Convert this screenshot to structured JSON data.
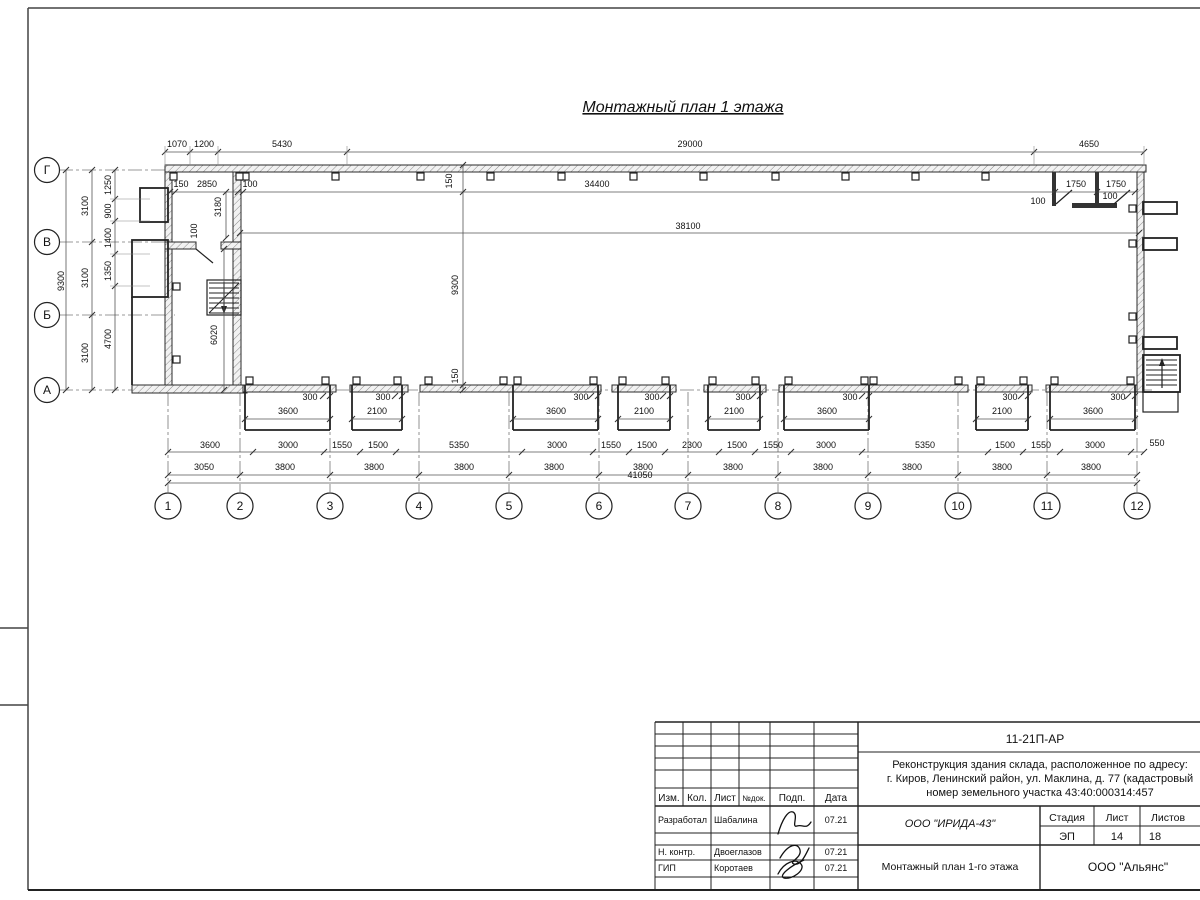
{
  "title": "Монтажный план 1 этажа",
  "plan": {
    "dims": [
      {
        "t": "1070",
        "x": 177,
        "y": 147
      },
      {
        "t": "1200",
        "x": 204,
        "y": 147
      },
      {
        "t": "5430",
        "x": 282,
        "y": 147
      },
      {
        "t": "29000",
        "x": 690,
        "y": 147
      },
      {
        "t": "4650",
        "x": 1089,
        "y": 147
      },
      {
        "t": "150",
        "x": 181,
        "y": 187
      },
      {
        "t": "2850",
        "x": 207,
        "y": 187
      },
      {
        "t": "100",
        "x": 250,
        "y": 187
      },
      {
        "t": "34400",
        "x": 597,
        "y": 187
      },
      {
        "t": "1750",
        "x": 1076,
        "y": 187
      },
      {
        "t": "1750",
        "x": 1116,
        "y": 187
      },
      {
        "t": "100",
        "x": 1038,
        "y": 204
      },
      {
        "t": "100",
        "x": 1110,
        "y": 199
      },
      {
        "t": "38100",
        "x": 688,
        "y": 229
      },
      {
        "t": "150",
        "x": 452,
        "y": 181,
        "r": -90
      },
      {
        "t": "9300",
        "x": 458,
        "y": 285,
        "r": -90
      },
      {
        "t": "150",
        "x": 458,
        "y": 376,
        "r": -90
      },
      {
        "t": "3180",
        "x": 221,
        "y": 207,
        "r": -90
      },
      {
        "t": "100",
        "x": 197,
        "y": 231,
        "r": -90
      },
      {
        "t": "6020",
        "x": 217,
        "y": 335,
        "r": -90
      },
      {
        "t": "1250",
        "x": 111,
        "y": 185,
        "r": -90
      },
      {
        "t": "900",
        "x": 111,
        "y": 211,
        "r": -90
      },
      {
        "t": "1400",
        "x": 111,
        "y": 238,
        "r": -90
      },
      {
        "t": "1350",
        "x": 111,
        "y": 271,
        "r": -90
      },
      {
        "t": "4700",
        "x": 111,
        "y": 339,
        "r": -90
      },
      {
        "t": "3100",
        "x": 88,
        "y": 206,
        "r": -90
      },
      {
        "t": "3100",
        "x": 88,
        "y": 278,
        "r": -90
      },
      {
        "t": "3100",
        "x": 88,
        "y": 353,
        "r": -90
      },
      {
        "t": "9300",
        "x": 64,
        "y": 281,
        "r": -90
      },
      {
        "t": "3600",
        "x": 288,
        "y": 414
      },
      {
        "t": "2100",
        "x": 377,
        "y": 414
      },
      {
        "t": "3600",
        "x": 556,
        "y": 414
      },
      {
        "t": "2100",
        "x": 644,
        "y": 414
      },
      {
        "t": "2100",
        "x": 734,
        "y": 414
      },
      {
        "t": "3600",
        "x": 827,
        "y": 414
      },
      {
        "t": "2100",
        "x": 1002,
        "y": 414
      },
      {
        "t": "3600",
        "x": 1093,
        "y": 414
      },
      {
        "t": "300",
        "x": 310,
        "y": 400
      },
      {
        "t": "300",
        "x": 383,
        "y": 400
      },
      {
        "t": "300",
        "x": 581,
        "y": 400
      },
      {
        "t": "300",
        "x": 652,
        "y": 400
      },
      {
        "t": "300",
        "x": 743,
        "y": 400
      },
      {
        "t": "300",
        "x": 850,
        "y": 400
      },
      {
        "t": "300",
        "x": 1010,
        "y": 400
      },
      {
        "t": "300",
        "x": 1118,
        "y": 400
      },
      {
        "t": "3600",
        "x": 210,
        "y": 448
      },
      {
        "t": "3000",
        "x": 288,
        "y": 448
      },
      {
        "t": "1550",
        "x": 342,
        "y": 448
      },
      {
        "t": "1500",
        "x": 378,
        "y": 448
      },
      {
        "t": "5350",
        "x": 459,
        "y": 448
      },
      {
        "t": "3000",
        "x": 557,
        "y": 448
      },
      {
        "t": "1550",
        "x": 611,
        "y": 448
      },
      {
        "t": "1500",
        "x": 647,
        "y": 448
      },
      {
        "t": "2300",
        "x": 692,
        "y": 448
      },
      {
        "t": "1500",
        "x": 737,
        "y": 448
      },
      {
        "t": "1550",
        "x": 773,
        "y": 448
      },
      {
        "t": "3000",
        "x": 826,
        "y": 448
      },
      {
        "t": "5350",
        "x": 925,
        "y": 448
      },
      {
        "t": "1500",
        "x": 1005,
        "y": 448
      },
      {
        "t": "1550",
        "x": 1041,
        "y": 448
      },
      {
        "t": "3000",
        "x": 1095,
        "y": 448
      },
      {
        "t": "550",
        "x": 1157,
        "y": 446
      },
      {
        "t": "3050",
        "x": 204,
        "y": 470
      },
      {
        "t": "3800",
        "x": 285,
        "y": 470
      },
      {
        "t": "3800",
        "x": 374,
        "y": 470
      },
      {
        "t": "3800",
        "x": 464,
        "y": 470
      },
      {
        "t": "3800",
        "x": 554,
        "y": 470
      },
      {
        "t": "3800",
        "x": 643,
        "y": 470
      },
      {
        "t": "3800",
        "x": 733,
        "y": 470
      },
      {
        "t": "3800",
        "x": 823,
        "y": 470
      },
      {
        "t": "3800",
        "x": 912,
        "y": 470
      },
      {
        "t": "3800",
        "x": 1002,
        "y": 470
      },
      {
        "t": "3800",
        "x": 1091,
        "y": 470
      },
      {
        "t": "41050",
        "x": 640,
        "y": 478
      }
    ],
    "axes_bottom": [
      "1",
      "2",
      "3",
      "4",
      "5",
      "6",
      "7",
      "8",
      "9",
      "10",
      "11",
      "12"
    ],
    "axes_left": [
      "Г",
      "В",
      "Б",
      "А"
    ]
  },
  "title_block": {
    "code": "11-21П-АР",
    "desc_line1": "Реконструкция здания склада, расположенное по адресу:",
    "desc_line2": "г. Киров, Ленинский район, ул. Маклина, д. 77 (кадастровый",
    "desc_line3": "номер земельного участка 43:40:000314:457",
    "cols": [
      "Изм.",
      "Кол.",
      "Лист",
      "№док.",
      "Подп.",
      "Дата"
    ],
    "rows": [
      {
        "role": "Разработал",
        "name": "Шабалина",
        "date": "07.21"
      },
      {
        "role": "Н. контр.",
        "name": "Двоеглазов",
        "date": "07.21"
      },
      {
        "role": "ГИП",
        "name": "Коротаев",
        "date": "07.21"
      }
    ],
    "org": "ООО \"ИРИДА-43\"",
    "stage_label": "Стадия",
    "sheet_label": "Лист",
    "sheets_label": "Листов",
    "stage": "ЭП",
    "sheet": "14",
    "sheets": "18",
    "drawing_title": "Монтажный план 1-го этажа",
    "company": "ООО \"Альянс\""
  }
}
